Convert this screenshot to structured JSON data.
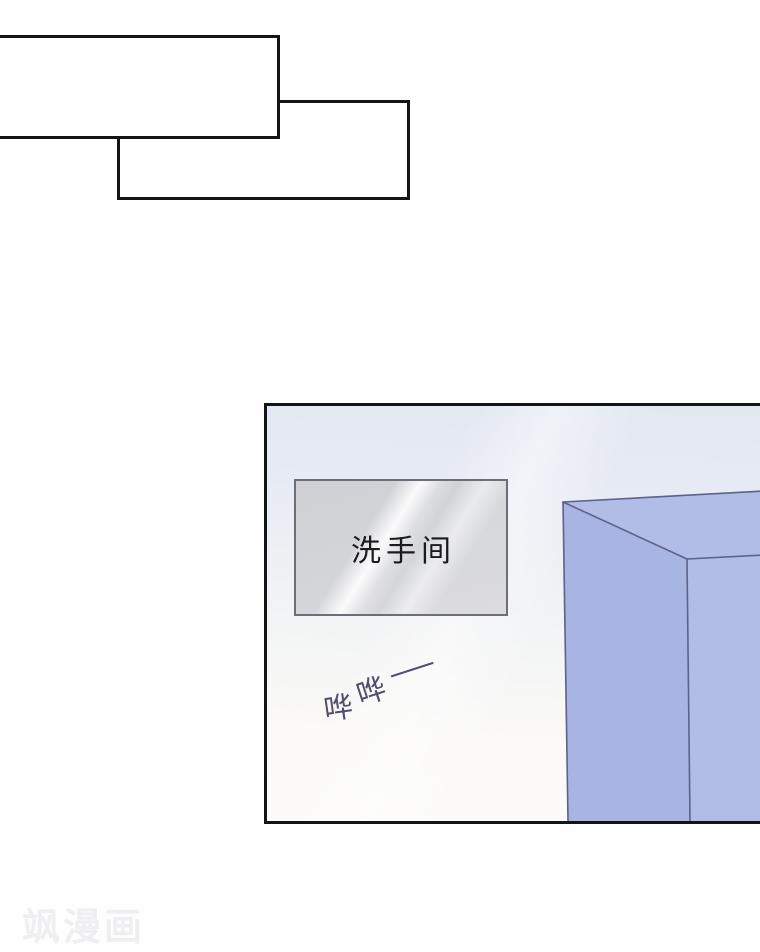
{
  "page": {
    "watermark_text": "飒漫画"
  },
  "speech_bubbles": [
    {
      "name": "speech-bubble-1",
      "text": ""
    },
    {
      "name": "speech-bubble-2",
      "text": ""
    }
  ],
  "panel": {
    "sign": {
      "text": "洗手间"
    },
    "sfx": {
      "chars": [
        "哗",
        "哗",
        "—"
      ]
    }
  },
  "colors": {
    "bubble_fill": "#ffffff",
    "bubble_border": "#141414",
    "panel_border": "#141414",
    "panel_bg_top": "#e2e7f2",
    "panel_bg_bottom": "#fcfbf9",
    "sign_fill": "#d2d3d8",
    "sign_border": "#6e6e78",
    "sign_text_color": "#1b1b1b",
    "sfx_ink": "#524c6d",
    "box_fill_left": "#a8b4e2",
    "box_fill_front": "#b1bce7",
    "box_stroke": "#5c6288",
    "watermark_color": "#efeff1"
  }
}
